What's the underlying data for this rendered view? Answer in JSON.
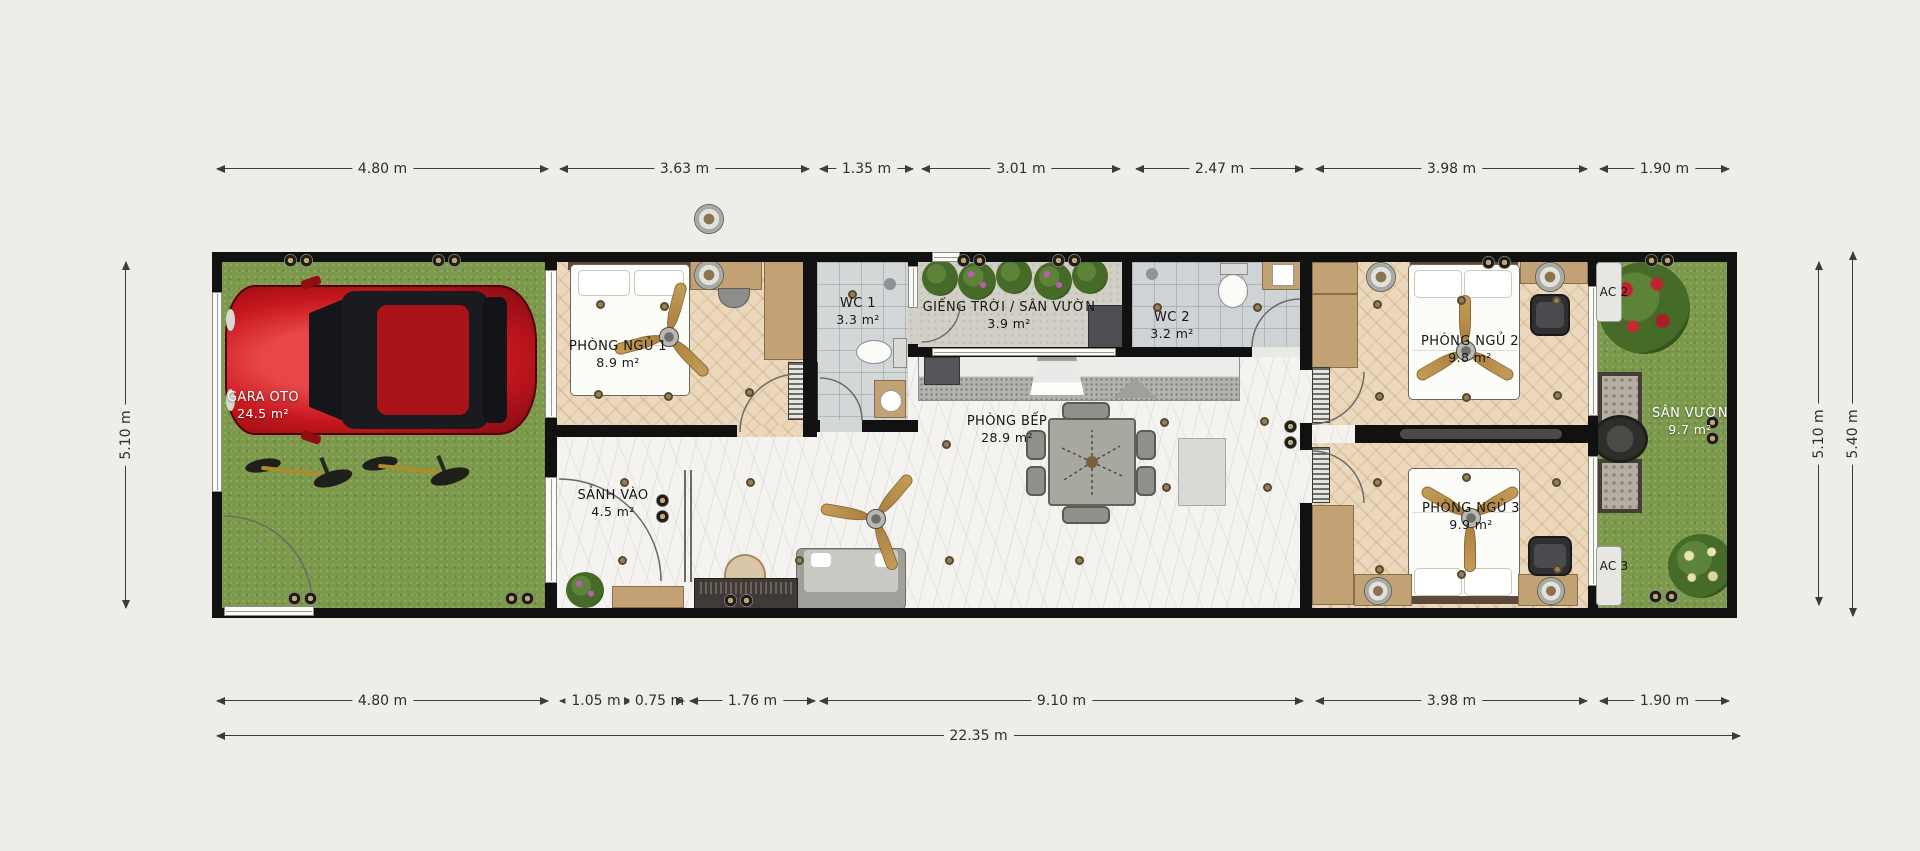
{
  "rooms": {
    "garage": {
      "name": "GARA OTO",
      "area": "24.5 m²"
    },
    "bedroom1": {
      "name": "PHÒNG NGỦ 1",
      "area": "8.9 m²"
    },
    "entry": {
      "name": "SẢNH VÀO",
      "area": "4.5 m²"
    },
    "wc1": {
      "name": "WC 1",
      "area": "3.3 m²"
    },
    "skylight": {
      "name": "GIẾNG TRỜI / SÂN VƯỜN",
      "area": "3.9 m²"
    },
    "kitchen": {
      "name": "PHÒNG BẾP",
      "area": "28.9 m²"
    },
    "wc2": {
      "name": "WC 2",
      "area": "3.2 m²"
    },
    "bedroom2": {
      "name": "PHÒNG NGỦ 2",
      "area": "9.8 m²"
    },
    "bedroom3": {
      "name": "PHÒNG NGỦ 3",
      "area": "9.9 m²"
    },
    "garden": {
      "name": "SÂN VƯỜN",
      "area": "9.7 m²"
    },
    "ac2": {
      "name": "AC 2"
    },
    "ac3": {
      "name": "AC 3"
    }
  },
  "dimensions": {
    "top": [
      "4.80 m",
      "3.63 m",
      "1.35 m",
      "3.01 m",
      "2.47 m",
      "3.98 m",
      "1.90 m"
    ],
    "bottom": [
      "4.80 m",
      "1.05 m",
      "0.75 m",
      "1.76 m",
      "9.10 m",
      "3.98 m",
      "1.90 m"
    ],
    "total": "22.35 m",
    "left": "5.10 m",
    "right_inner": "5.10 m",
    "right_outer": "5.40 m"
  },
  "colors": {
    "background": "#EDEEE8",
    "wall": "#111111",
    "grass": "#7D9A4C",
    "wood": "#ECD9BD",
    "marble": "#F4F3EF",
    "tile": "#CBCED0",
    "car_red": "#C6161D",
    "fan_blade": "#C59C57",
    "dim_line": "#3C3C3C"
  }
}
